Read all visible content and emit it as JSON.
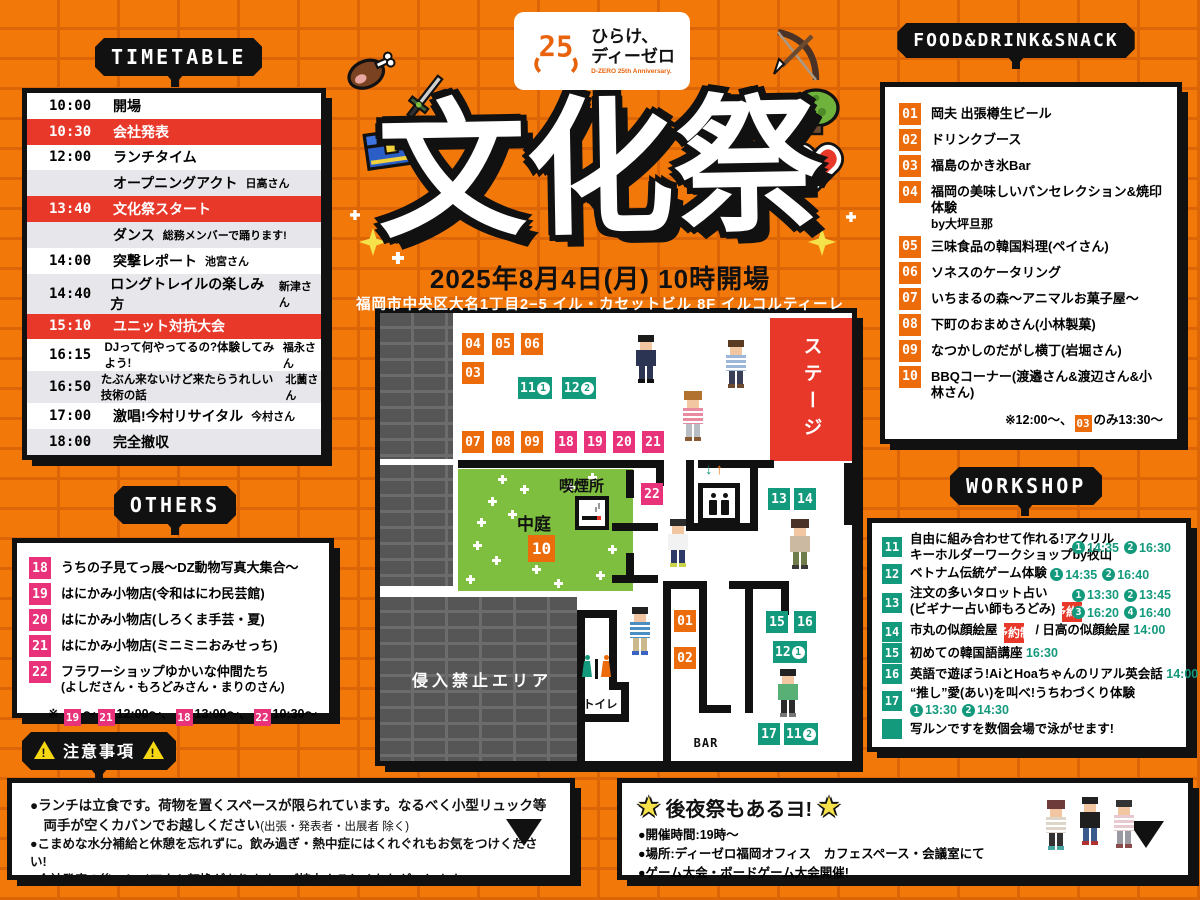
{
  "logo": {
    "mark": "25",
    "line1": "ひらけ、",
    "line2": "ディーゼロ",
    "sub": "D-ZERO 25th Anniversary."
  },
  "hero": {
    "title": "文化祭",
    "date": "2025年8月4日(月) 10時開場",
    "venue": "福岡市中央区大名1丁目2−5 イル・カセットビル 8F イルコルティーレ"
  },
  "timetable": {
    "title": "TIMETABLE",
    "rows": [
      {
        "time": "10:00",
        "label": "開場",
        "note": "",
        "bg": "white"
      },
      {
        "time": "10:30",
        "label": "会社発表",
        "note": "",
        "bg": "red"
      },
      {
        "time": "12:00",
        "label": "ランチタイム",
        "note": "",
        "bg": "white"
      },
      {
        "time": "",
        "label": "オープニングアクト",
        "note": "日高さん",
        "bg": "gray"
      },
      {
        "time": "13:40",
        "label": "文化祭スタート",
        "note": "",
        "bg": "red"
      },
      {
        "time": "",
        "label": "ダンス",
        "note": "総務メンバーで踊ります!",
        "bg": "gray"
      },
      {
        "time": "14:00",
        "label": "突撃レポート",
        "note": "池宮さん",
        "bg": "white"
      },
      {
        "time": "14:40",
        "label": "ロングトレイルの楽しみ方",
        "note": "新津さん",
        "bg": "gray"
      },
      {
        "time": "15:10",
        "label": "ユニット対抗大会",
        "note": "",
        "bg": "red"
      },
      {
        "time": "16:15",
        "label": "DJって何やってるの?体験してみよう!",
        "note": "福永さん",
        "bg": "white",
        "small": true
      },
      {
        "time": "16:50",
        "label": "たぶん来ないけど来たらうれしい技術の話",
        "note": "北薗さん",
        "bg": "gray",
        "small": true
      },
      {
        "time": "17:00",
        "label": "激唱!今村リサイタル",
        "note": "今村さん",
        "bg": "white"
      },
      {
        "time": "18:00",
        "label": "完全撤収",
        "note": "",
        "bg": "gray"
      }
    ]
  },
  "others": {
    "title": "OTHERS",
    "items": [
      {
        "num": "18",
        "label": "うちの子見てっ展〜DZ動物写真大集合〜"
      },
      {
        "num": "19",
        "label": "はにかみ小物店(令和はにわ民芸館)"
      },
      {
        "num": "20",
        "label": "はにかみ小物店(しろくま手芸・夏)"
      },
      {
        "num": "21",
        "label": "はにかみ小物店(ミニミニおみせっち)"
      },
      {
        "num": "22",
        "label": "フラワーショップゆかいな仲間たち",
        "label2": "(よしださん・もろどみさん・まりのさん)"
      }
    ],
    "footnote": [
      {
        "t": "text",
        "v": "※ "
      },
      {
        "t": "badge",
        "v": "19",
        "c": "pink"
      },
      {
        "t": "text",
        "v": "〜"
      },
      {
        "t": "badge",
        "v": "21",
        "c": "pink"
      },
      {
        "t": "text",
        "v": "12:00〜、"
      },
      {
        "t": "badge",
        "v": "18",
        "c": "pink"
      },
      {
        "t": "text",
        "v": "13:00〜、"
      },
      {
        "t": "badge",
        "v": "22",
        "c": "pink"
      },
      {
        "t": "text",
        "v": "10:30〜"
      }
    ]
  },
  "food": {
    "title": "FOOD&DRINK&SNACK",
    "items": [
      {
        "num": "01",
        "label": "岡夫 出張樽生ビール"
      },
      {
        "num": "02",
        "label": "ドリンクブース"
      },
      {
        "num": "03",
        "label": "福島のかき氷Bar"
      },
      {
        "num": "04",
        "label": "福岡の美味しいパンセレクション&焼印体験",
        "label2": "by大坪旦那"
      },
      {
        "num": "05",
        "label": "三味食品の韓国料理(ペイさん)"
      },
      {
        "num": "06",
        "label": "ソネスのケータリング"
      },
      {
        "num": "07",
        "label": "いちまるの森〜アニマルお菓子屋〜"
      },
      {
        "num": "08",
        "label": "下町のおまめさん(小林製菓)"
      },
      {
        "num": "09",
        "label": "なつかしのだがし横丁(岩堀さん)"
      },
      {
        "num": "10",
        "label": "BBQコーナー(渡邉さん&渡辺さん&小林さん)"
      }
    ],
    "footnote": [
      {
        "t": "text",
        "v": "※12:00〜、"
      },
      {
        "t": "badge",
        "v": "03",
        "c": "orange"
      },
      {
        "t": "text",
        "v": "のみ13:30〜"
      }
    ]
  },
  "workshop": {
    "title": "WORKSHOP",
    "items": [
      {
        "num": "11",
        "lines": [
          [
            {
              "t": "text",
              "v": "自由に組み合わせて作れる!アクリル"
            }
          ],
          [
            {
              "t": "text",
              "v": "キーホルダーワークショップby牧山"
            }
          ]
        ],
        "right": [
          [
            {
              "t": "slot",
              "n": "1",
              "v": "14:35"
            },
            {
              "t": "slot",
              "n": "2",
              "v": "16:30"
            }
          ]
        ]
      },
      {
        "num": "12",
        "lines": [
          [
            {
              "t": "text",
              "v": "ベトナム伝統ゲーム体験 "
            },
            {
              "t": "slot",
              "n": "1",
              "v": "14:35"
            },
            {
              "t": "slot",
              "n": "2",
              "v": "16:40"
            }
          ]
        ]
      },
      {
        "num": "13",
        "lines": [
          [
            {
              "t": "text",
              "v": "注文の多いタロット占い"
            }
          ],
          [
            {
              "t": "text",
              "v": "(ビギナー占い師もろどみ) "
            },
            {
              "t": "badge",
              "v": "予約制",
              "c": "red"
            }
          ]
        ],
        "right": [
          [
            {
              "t": "slot",
              "n": "1",
              "v": "13:30"
            },
            {
              "t": "slot",
              "n": "2",
              "v": "13:45"
            }
          ],
          [
            {
              "t": "slot",
              "n": "3",
              "v": "16:20"
            },
            {
              "t": "slot",
              "n": "4",
              "v": "16:40"
            }
          ]
        ]
      },
      {
        "num": "14",
        "lines": [
          [
            {
              "t": "text",
              "v": "市丸の似顔絵屋 "
            },
            {
              "t": "badge",
              "v": "予約制",
              "c": "red"
            },
            {
              "t": "text",
              "v": " / 日高の似顔絵屋 "
            },
            {
              "t": "time",
              "v": "14:00"
            }
          ]
        ]
      },
      {
        "num": "15",
        "lines": [
          [
            {
              "t": "text",
              "v": "初めての韓国語講座 "
            },
            {
              "t": "time",
              "v": "16:30"
            }
          ]
        ]
      },
      {
        "num": "16",
        "lines": [
          [
            {
              "t": "text",
              "v": "英語で遊ぼう!AiとHoaちゃんのリアル英会話 "
            },
            {
              "t": "time",
              "v": "14:00"
            }
          ]
        ]
      },
      {
        "num": "17",
        "lines": [
          [
            {
              "t": "text",
              "v": "“推し”愛(あい)を叫べ!うちわづくり体験"
            }
          ],
          [
            {
              "t": "slot",
              "n": "1",
              "v": "13:30"
            },
            {
              "t": "slot",
              "n": "2",
              "v": "14:30"
            }
          ]
        ]
      },
      {
        "num": "",
        "lines": [
          [
            {
              "t": "text",
              "v": "写ルンですを数個会場で泳がせます!"
            }
          ]
        ]
      }
    ]
  },
  "map": {
    "labels": {
      "stage": "ステージ",
      "courtyard": "中庭",
      "smoking": "喫煙所",
      "no_entry": "侵入禁止エリア",
      "toilet": "トイレ",
      "bar": "BAR"
    },
    "elevator": {
      "down": "↓",
      "up": "↑"
    },
    "badges": [
      {
        "label": "04",
        "color": "orange",
        "x": 82,
        "y": 20
      },
      {
        "label": "05",
        "color": "orange",
        "x": 112,
        "y": 20
      },
      {
        "label": "06",
        "color": "orange",
        "x": 141,
        "y": 20
      },
      {
        "label": "03",
        "color": "orange",
        "x": 82,
        "y": 49
      },
      {
        "label": "11",
        "slot": "1",
        "color": "green",
        "x": 138,
        "y": 64
      },
      {
        "label": "12",
        "slot": "2",
        "color": "green",
        "x": 182,
        "y": 64
      },
      {
        "label": "07",
        "color": "orange",
        "x": 82,
        "y": 118
      },
      {
        "label": "08",
        "color": "orange",
        "x": 112,
        "y": 118
      },
      {
        "label": "09",
        "color": "orange",
        "x": 141,
        "y": 118
      },
      {
        "label": "18",
        "color": "pink",
        "x": 175,
        "y": 118
      },
      {
        "label": "19",
        "color": "pink",
        "x": 204,
        "y": 118
      },
      {
        "label": "20",
        "color": "pink",
        "x": 233,
        "y": 118
      },
      {
        "label": "21",
        "color": "pink",
        "x": 262,
        "y": 118
      },
      {
        "label": "22",
        "color": "pink",
        "x": 261,
        "y": 170
      },
      {
        "label": "13",
        "color": "green",
        "x": 388,
        "y": 175
      },
      {
        "label": "14",
        "color": "green",
        "x": 414,
        "y": 175
      },
      {
        "label": "10",
        "color": "orange",
        "x": 148,
        "y": 222,
        "big": true
      },
      {
        "label": "01",
        "color": "orange",
        "x": 294,
        "y": 297
      },
      {
        "label": "02",
        "color": "orange",
        "x": 294,
        "y": 334
      },
      {
        "label": "15",
        "color": "green",
        "x": 386,
        "y": 298
      },
      {
        "label": "16",
        "color": "green",
        "x": 414,
        "y": 298
      },
      {
        "label": "12",
        "slot": "1",
        "color": "green",
        "x": 393,
        "y": 328
      },
      {
        "label": "17",
        "color": "green",
        "x": 378,
        "y": 410
      },
      {
        "label": "11",
        "slot": "2",
        "color": "green",
        "x": 404,
        "y": 410
      }
    ],
    "walls": [
      [
        78,
        147,
        206,
        8
      ],
      [
        276,
        147,
        8,
        26
      ],
      [
        318,
        147,
        76,
        8
      ],
      [
        306,
        147,
        8,
        71
      ],
      [
        306,
        210,
        72,
        8
      ],
      [
        370,
        147,
        8,
        71
      ],
      [
        246,
        157,
        8,
        28
      ],
      [
        232,
        210,
        46,
        8
      ],
      [
        246,
        240,
        8,
        24
      ],
      [
        232,
        262,
        46,
        8
      ],
      [
        197,
        297,
        8,
        151
      ],
      [
        197,
        297,
        40,
        8
      ],
      [
        229,
        297,
        8,
        78
      ],
      [
        229,
        369,
        20,
        8
      ],
      [
        241,
        369,
        8,
        40
      ],
      [
        197,
        401,
        52,
        8
      ],
      [
        283,
        268,
        8,
        180
      ],
      [
        283,
        268,
        44,
        8
      ],
      [
        319,
        276,
        8,
        124
      ],
      [
        319,
        392,
        32,
        8
      ],
      [
        349,
        268,
        60,
        8
      ],
      [
        365,
        276,
        8,
        124
      ],
      [
        401,
        276,
        8,
        26
      ],
      [
        464,
        150,
        8,
        62
      ]
    ],
    "flowers": [
      [
        118,
        162
      ],
      [
        140,
        172
      ],
      [
        108,
        184
      ],
      [
        128,
        197
      ],
      [
        93,
        228
      ],
      [
        112,
        243
      ],
      [
        86,
        262
      ],
      [
        152,
        252
      ],
      [
        174,
        266
      ],
      [
        208,
        160
      ],
      [
        216,
        258
      ],
      [
        228,
        232
      ],
      [
        186,
        170
      ],
      [
        97,
        205
      ]
    ],
    "people": [
      {
        "x": 256,
        "y": 22,
        "hair": "#1b1b1b",
        "top": "#2b3553",
        "bot": "#2b3553",
        "shoe": "#111111"
      },
      {
        "x": 346,
        "y": 27,
        "hair": "#5a3b22",
        "top": "#9db7d8",
        "bot": "#3a3f55",
        "shoe": "#6b4a2f",
        "striped": true
      },
      {
        "x": 303,
        "y": 78,
        "hair": "#b0722e",
        "top": "#e88aa0",
        "bot": "#b9bdc4",
        "shoe": "#8a5a33",
        "long": true,
        "striped": true
      },
      {
        "x": 288,
        "y": 206,
        "hair": "#2b2b2b",
        "top": "#f2f2f2",
        "bot": "#2e3a68",
        "shoe": "#c9d44a"
      },
      {
        "x": 410,
        "y": 206,
        "hair": "#4a3227",
        "top": "#cbb9a2",
        "bot": "#6f7d4a",
        "shoe": "#3a3a3a",
        "long": true
      },
      {
        "x": 250,
        "y": 294,
        "hair": "#222222",
        "top": "#4a8ec2",
        "bot": "#cbb98e",
        "shoe": "#3a62c4",
        "striped": true
      },
      {
        "x": 398,
        "y": 356,
        "hair": "#222222",
        "top": "#58b077",
        "bot": "#2b2b2b",
        "shoe": "#777777"
      }
    ]
  },
  "notice": {
    "title": "注意事項",
    "lines": [
      {
        "bold": true,
        "segments": [
          {
            "t": "text",
            "v": "●ランチは立食です。荷物を置くスペースが限られています。なるべく小型リュック等"
          }
        ]
      },
      {
        "bold": true,
        "segments": [
          {
            "t": "text",
            "v": "　両手が空くカバンでお越しください"
          },
          {
            "t": "sub",
            "v": "(出張・発表者・出展者 除く)"
          }
        ]
      },
      {
        "segments": [
          {
            "t": "text",
            "v": "●こまめな水分補給と休憩を忘れずに。飲み過ぎ・熱中症にはくれぐれもお気をつけください!"
          }
        ]
      },
      {
        "segments": [
          {
            "t": "text",
            "v": "●会社発表の後、レイアウト転換があります。ご協力よろしくおねがいします。"
          }
        ]
      }
    ]
  },
  "afterparty": {
    "star": "★",
    "title": "後夜祭もあるヨ!",
    "lines": [
      "●開催時間:19時〜",
      "●場所:ディーゼロ福岡オフィス　カフェスペース・会議室にて",
      "●ゲーム大会・ボードゲーム大会開催!"
    ],
    "people": [
      {
        "x": 1046,
        "y": 800,
        "hair": "#6e3a3a",
        "top": "#ddd5c8",
        "bot": "#333333",
        "shoe": "#4aa5a0",
        "long": true,
        "striped": true
      },
      {
        "x": 1080,
        "y": 797,
        "hair": "#222222",
        "top": "#1f1f1f",
        "bot": "#3a5a8c",
        "shoe": "#b03030"
      },
      {
        "x": 1114,
        "y": 800,
        "hair": "#333333",
        "top": "#e8c9cf",
        "bot": "#9a9aa2",
        "shoe": "#8a4a4a",
        "striped": true
      }
    ]
  },
  "icons": {
    "decorations": [
      "meat-icon",
      "sword-icon",
      "treasure-chest-icon",
      "bow-arrow-icon",
      "bush-icon",
      "heart-icon",
      "sparkle-icon",
      "warning-icon",
      "star-icon",
      "down-arrow-icon"
    ]
  },
  "colors": {
    "background": "#F3780A",
    "mortar": "#DC6508",
    "black": "#111111",
    "red": "#E7382A",
    "pink": "#E8327A",
    "orange_badge": "#EC6C0C",
    "green_badge": "#13997C",
    "grass": "#7FBF3F",
    "gray_wall": "#565656",
    "row_gray": "#E7E7EB",
    "yellow": "#F5E14A"
  }
}
